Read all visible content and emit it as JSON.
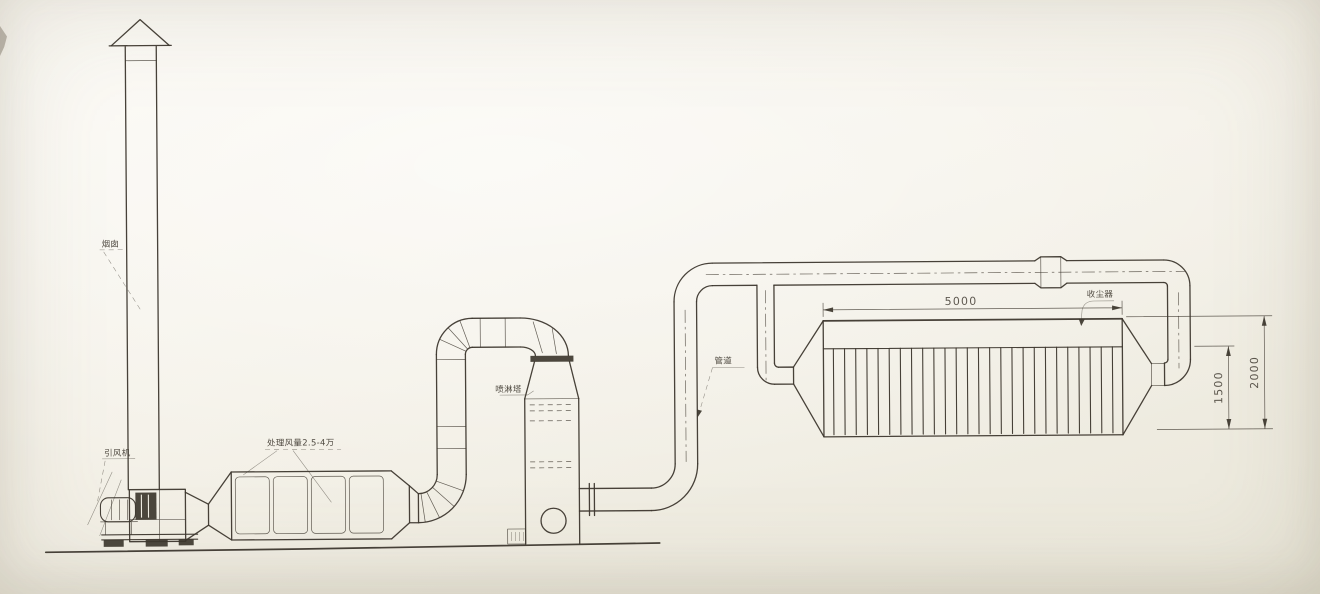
{
  "document": {
    "type": "engineering elevation drawing",
    "subject": "industrial exhaust gas treatment / dust collection system",
    "paper_color": "#f4f1e8",
    "ink_color": "#3d372e"
  },
  "labels": {
    "chimney": "烟囱",
    "fan": "引风机",
    "filter_box": "处理风量2.5-4万",
    "scrubber": "喷淋塔",
    "duct": "管道",
    "dust_collector": "收尘器"
  },
  "dimensions": {
    "collector_length": "5000",
    "bag_section_height": "1500",
    "collector_overall_height": "2000"
  },
  "dust_collector": {
    "bag_count": 26
  }
}
